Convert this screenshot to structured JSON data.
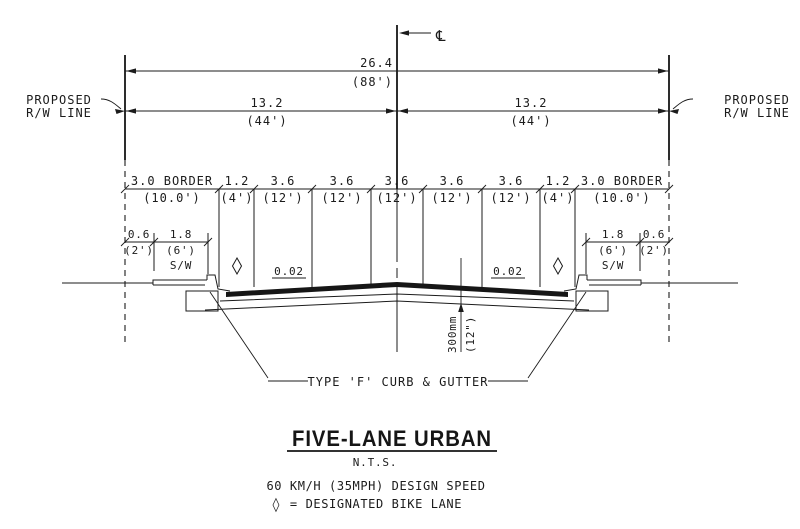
{
  "annotations": {
    "centerline_symbol": "℄",
    "rw_left": {
      "line1": "PROPOSED",
      "line2": "R/W LINE"
    },
    "rw_right": {
      "line1": "PROPOSED",
      "line2": "R/W LINE"
    },
    "slope_left": "0.02",
    "slope_right": "0.02",
    "sw_left": "S/W",
    "sw_right": "S/W",
    "curb_callout": "TYPE 'F' CURB & GUTTER"
  },
  "dimensions": {
    "overall": {
      "m": "26.4",
      "ft": "(88')"
    },
    "left_half": {
      "m": "13.2",
      "ft": "(44')"
    },
    "right_half": {
      "m": "13.2",
      "ft": "(44')"
    },
    "lanes": [
      {
        "m": "3.0 BORDER",
        "ft": "(10.0')"
      },
      {
        "m": "1.2",
        "ft": "(4')"
      },
      {
        "m": "3.6",
        "ft": "(12')"
      },
      {
        "m": "3.6",
        "ft": "(12')"
      },
      {
        "m": "3.6",
        "ft": "(12')"
      },
      {
        "m": "3.6",
        "ft": "(12')"
      },
      {
        "m": "3.6",
        "ft": "(12')"
      },
      {
        "m": "1.2",
        "ft": "(4')"
      },
      {
        "m": "3.0 BORDER",
        "ft": "(10.0')"
      }
    ],
    "sw_left_dims": [
      {
        "m": "0.6",
        "ft": "(2')"
      },
      {
        "m": "1.8",
        "ft": "(6')"
      }
    ],
    "sw_right_dims": [
      {
        "m": "1.8",
        "ft": "(6')"
      },
      {
        "m": "0.6",
        "ft": "(2')"
      }
    ],
    "depth": {
      "m": "300mm",
      "ft": "(12\")"
    }
  },
  "symbols": {
    "bike_diamond": "◊"
  },
  "title_block": {
    "title": "FIVE-LANE URBAN",
    "scale": "N.T.S.",
    "design_speed": "60 KM/H (35MPH) DESIGN SPEED",
    "legend_symbol": "◊",
    "legend_text": "= DESIGNATED BIKE LANE"
  }
}
